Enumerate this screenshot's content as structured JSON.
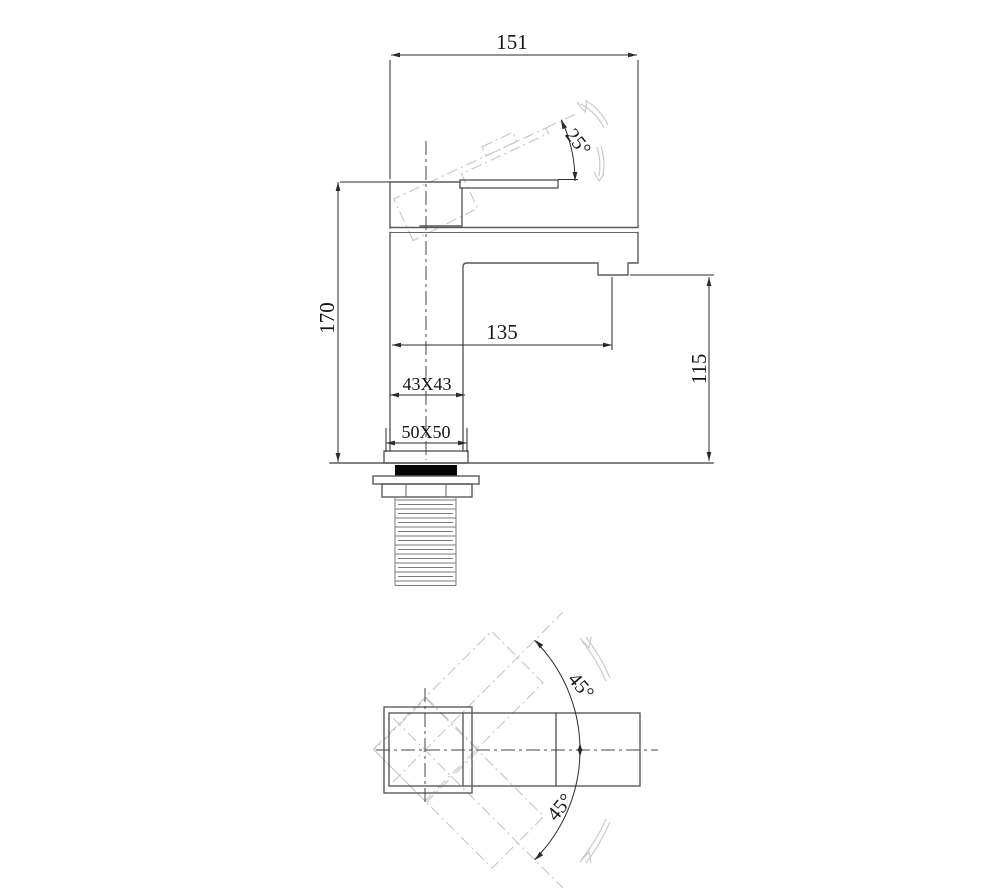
{
  "drawing": {
    "title": "square single-lever basin mixer technical drawing",
    "views": [
      "side-elevation",
      "plan"
    ],
    "dims": {
      "overall_width": "151",
      "overall_height": "170",
      "spout_reach": "135",
      "outlet_height": "115",
      "body_section": "43X43",
      "base_section": "50X50",
      "handle_angle": "25°",
      "handle_swing_upper": "45°",
      "handle_swing_lower": "45°"
    },
    "colors": {
      "background": "#ffffff",
      "object_line": "#5a5a5a",
      "dimension_line": "#2b2b2b",
      "phantom_line": "#c6c6c6",
      "motion_arrow": "#cbcbcb",
      "gasket_fill": "#060606"
    }
  }
}
